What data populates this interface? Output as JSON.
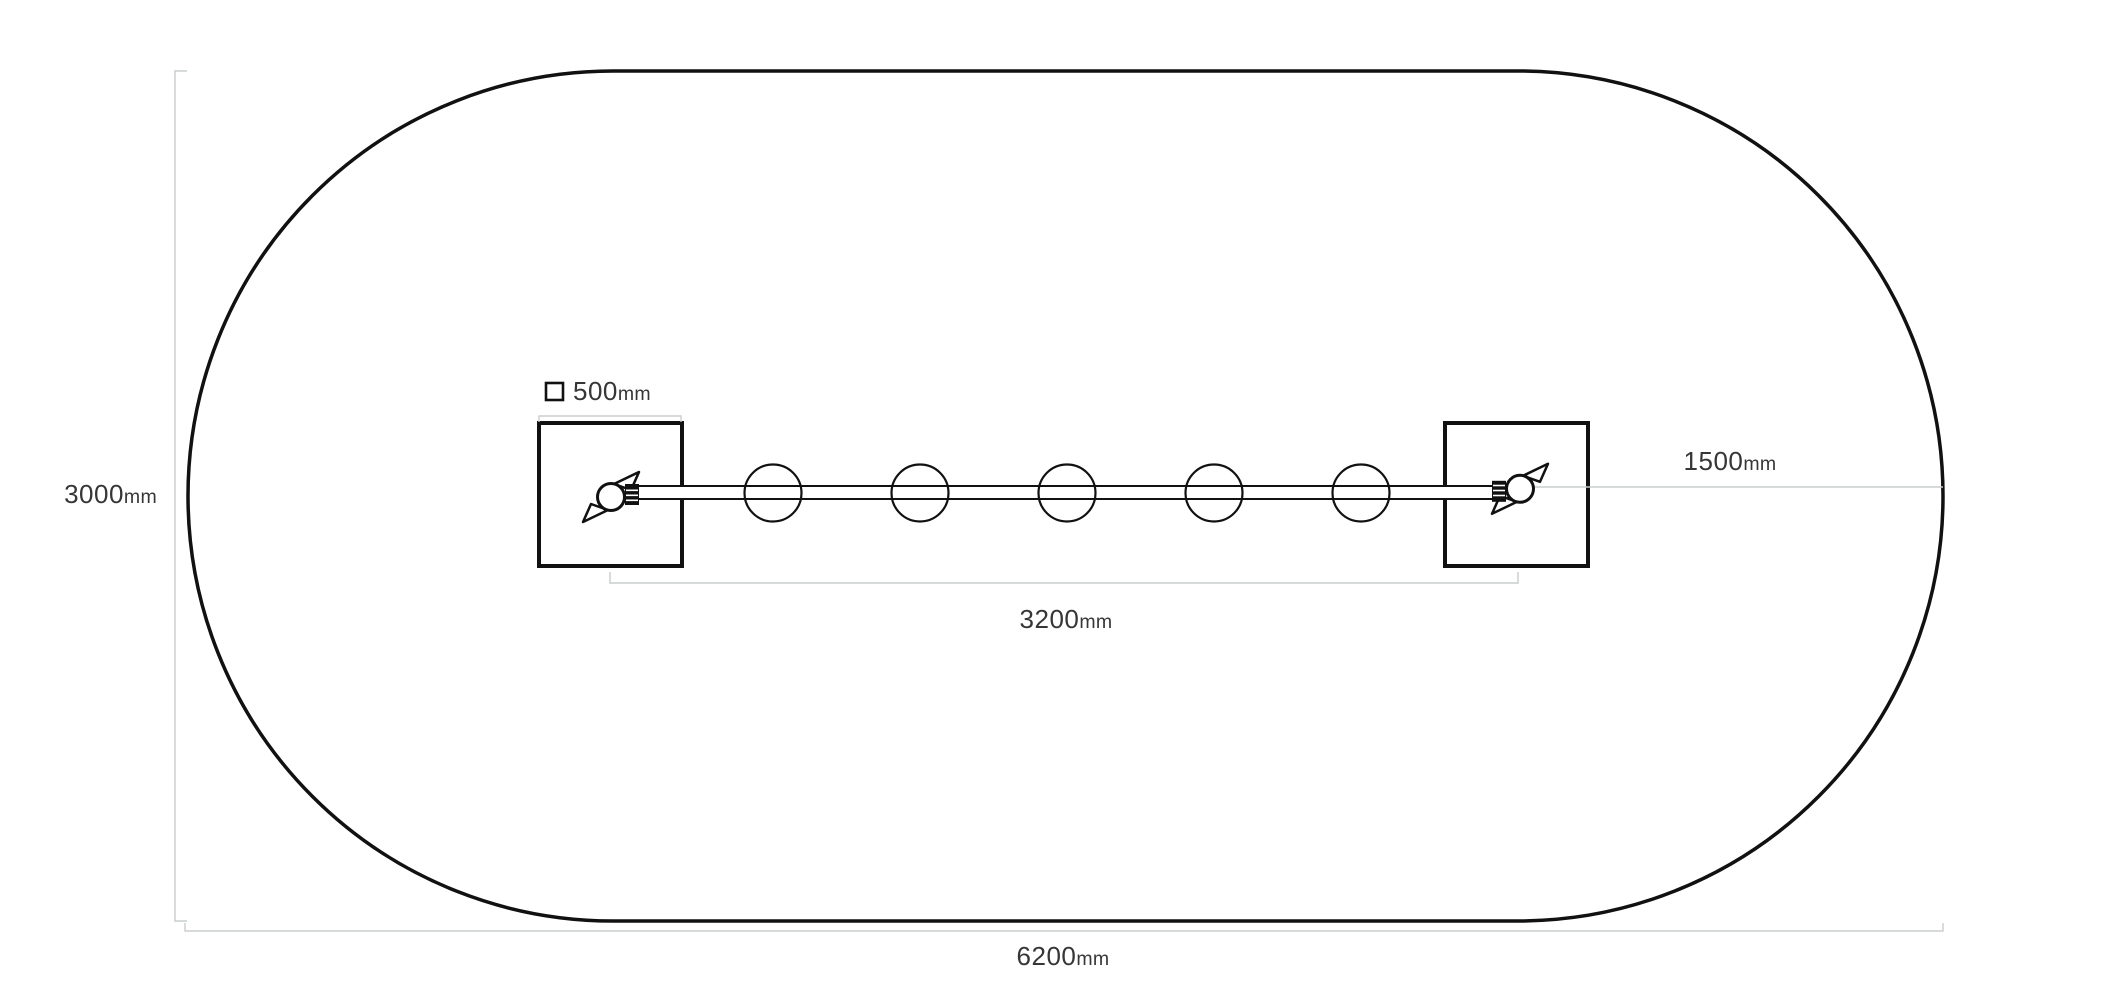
{
  "diagram": {
    "title": "overhead-ladder-plan-view-with-safety-zone",
    "colors": {
      "outline": "#111111",
      "dimension_line": "#c9cdcb",
      "label_text": "#363636",
      "background": "#ffffff"
    },
    "dims": {
      "zone_depth": {
        "value": "3000",
        "unit": "mm"
      },
      "zone_width": {
        "value": "6200",
        "unit": "mm"
      },
      "post_size": {
        "value": "500",
        "unit": "mm",
        "icon": "square-outline-icon"
      },
      "beam_span": {
        "value": "3200",
        "unit": "mm"
      },
      "side_clearance": {
        "value": "1500",
        "unit": "mm"
      }
    },
    "equipment": {
      "posts": 2,
      "rungs": 5,
      "figures": 2
    }
  }
}
